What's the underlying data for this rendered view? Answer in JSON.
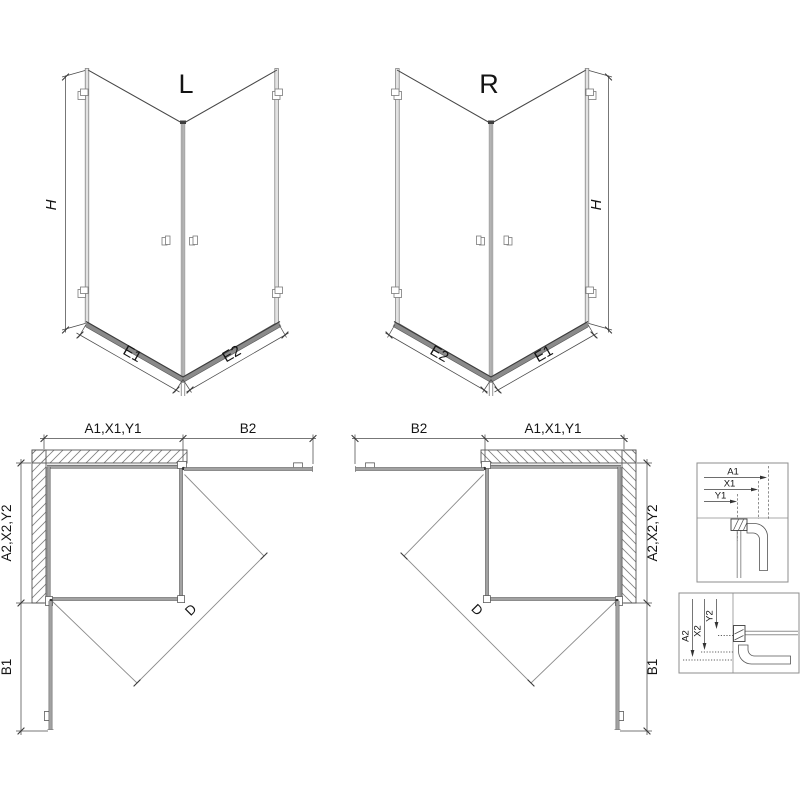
{
  "views": {
    "front_left": {
      "version_label": "L",
      "height_label": "H",
      "bottom_left_label": "E1",
      "bottom_right_label": "E2"
    },
    "front_right": {
      "version_label": "R",
      "height_label": "H",
      "bottom_left_label": "E2",
      "bottom_right_label": "E1"
    },
    "plan_left": {
      "top_left_dim": "A1,X1,Y1",
      "top_right_dim": "B2",
      "side_upper_dim": "A2,X2,Y2",
      "side_lower_dim": "B1",
      "diagonal_dim": "D"
    },
    "plan_right": {
      "top_left_dim": "B2",
      "top_right_dim": "A1,X1,Y1",
      "side_upper_dim": "A2,X2,Y2",
      "side_lower_dim": "B1",
      "diagonal_dim": "D"
    },
    "detail_top": {
      "dims": [
        "A1",
        "X1",
        "Y1"
      ]
    },
    "detail_bottom": {
      "dims": [
        "A2",
        "X2",
        "Y2"
      ]
    }
  },
  "colors": {
    "background": "#ffffff",
    "line": "#3f3f3f",
    "dimension": "#4a4a4a",
    "glass_profile": "#9a9a9a",
    "threshold": "#8a8a8a",
    "hatch": "#7f7f7f"
  }
}
